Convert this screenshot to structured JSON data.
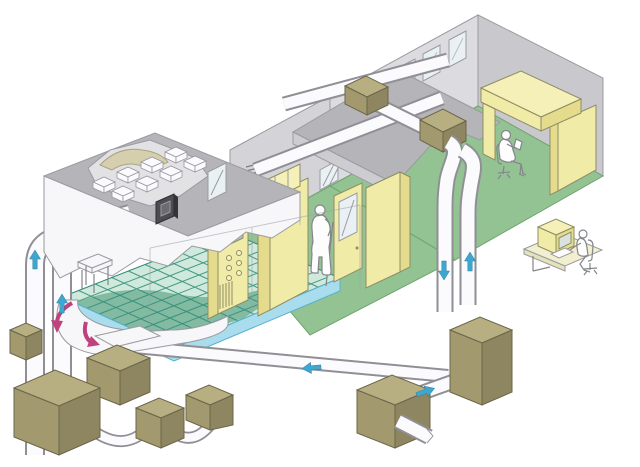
{
  "diagram": {
    "type": "isometric-cutaway-illustration",
    "subject": "cleanroom-facility-hvac-airflow",
    "rooms": [
      {
        "name": "cleanroom",
        "features": [
          "hepa-filter-ceiling-plenum",
          "raised-access-floor-grid",
          "underfloor-air-plenum",
          "process-cabinet-with-controls",
          "tall-process-cabinet",
          "door-with-window",
          "side-cabinet",
          "small-table",
          "wall-control-panel",
          "window",
          "vent-grille"
        ]
      },
      {
        "name": "corridor",
        "features": [
          "green-floor",
          "hatched-window",
          "standing-operator"
        ]
      },
      {
        "name": "office",
        "features": [
          "three-windows",
          "l-shaped-desk",
          "seated-worker",
          "green-floor"
        ]
      }
    ],
    "hvac": {
      "rooftop_duct_runs": 3,
      "rooftop_units": 2,
      "supply_risers_left": 2,
      "front_risers_right": 2,
      "ahu_boxes_right": 2,
      "outdoor_units_bottom": 5,
      "interconnecting_pipes": 2,
      "floor_level_duct": 1,
      "outlet_stub": 1
    },
    "airflow_arrows": {
      "cyan_up": [
        "left-riser-outer",
        "left-riser-inner",
        "right-riser-front"
      ],
      "cyan_down": [
        "right-riser-back"
      ],
      "cyan_left": [
        "floor-level-duct"
      ],
      "cyan_right": [
        "ahu-link-duct"
      ],
      "pink_circulating": [
        "underfloor-plenum-a",
        "underfloor-plenum-b"
      ]
    },
    "people": [
      "standing-operator-cleanroom",
      "seated-worker-office",
      "seated-worker-computer-desk"
    ],
    "furniture": [
      "office-desk",
      "computer-desk",
      "desktop-computer",
      "keyboard",
      "office-chairs"
    ],
    "colors": {
      "background": "#ffffff",
      "wall_light": "#dcdce0",
      "wall_mid": "#c9c9cd",
      "roof_gray": "#b5b5b9",
      "room_floor_green": "#93c393",
      "raised_floor_teal": "#cfe9dc",
      "raised_floor_dark": "#68ab8e",
      "floor_grid_line": "#2f8a76",
      "floor_edge_blue": "#a9dcec",
      "cabinet_yellow": "#f1eba8",
      "unit_khaki": "#a29a6e",
      "duct_white": "#fbfbfd",
      "arrow_cyan": "#3fa7cf",
      "arrow_pink": "#c0427c",
      "control_panel_dark": "#4c4c52"
    }
  }
}
